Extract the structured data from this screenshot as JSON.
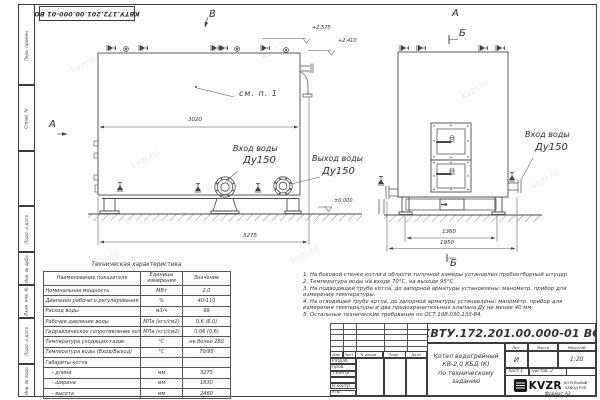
{
  "watermark": "kvzr.ru",
  "doc_number": "КВТУ.172.201.00.000-01 ВО",
  "margin_labels": [
    "Перв. примен.",
    "Справ. №",
    "Подп. и дата",
    "Инв. № дубл.",
    "Взам. инв. №",
    "Подп. и дата",
    "Инв. № подл."
  ],
  "views": {
    "front": {
      "label_top": "В",
      "label_left": "А",
      "callout": "см. п. 1",
      "dim_inner": "3020",
      "dim_overall": "3275",
      "elev_top": "+2.575",
      "elev_top2": "+2.410",
      "elev_zero": "±0.000",
      "inlet_line1": "Вход воды",
      "inlet_line2": "Ду150",
      "outlet_line1": "Выход воды",
      "outlet_line2": "Ду150"
    },
    "side": {
      "label_top": "А",
      "section_top": "Б",
      "section_bottom": "Б",
      "inlet_line1": "Вход воды",
      "inlet_line2": "Ду150",
      "dim_legs": "1360",
      "dim_overall": "1950"
    }
  },
  "spec_table": {
    "title": "Техническая характеристика",
    "headers": [
      "Наименование показателя",
      "Единицы измерения",
      "Значение"
    ],
    "rows": [
      [
        "Номинальная мощность",
        "МВт",
        "2,0"
      ],
      [
        "Диапазон рабочего регулирования",
        "%",
        "40-110"
      ],
      [
        "Расход воды",
        "м3/ч",
        "69"
      ],
      [
        "Рабочее давление воды",
        "МПа (кгс/см2)",
        "0,6 (6,0)"
      ],
      [
        "Гидравлическое сопротивление котла",
        "МПа (кгс/см2)",
        "0,06 (0,6)"
      ],
      [
        "Температура уходящих газов",
        "°С",
        "не более 280"
      ],
      [
        "Температура воды (Вход/Выход)",
        "°С",
        "70/95"
      ],
      [
        "Габариты котла",
        "",
        ""
      ],
      [
        "    - длина",
        "мм",
        "3275"
      ],
      [
        "    - ширина",
        "мм",
        "1830"
      ],
      [
        "    - высота",
        "мм",
        "2460"
      ]
    ]
  },
  "notes": [
    "1.  На боковой стенке котла в области топочной камеры установлен пробоотборный штуцер",
    "2.  Температура воды на входе 70°С, на выходе 95°С.",
    "3.  На подводящей трубе котла, до запорной арматуры установлены: манометр, прибор для измерения температуры.",
    "4.  На отводящей трубе котла, до запорной арматуры установлены: манометр, прибор для измерения температуры и два предохранительных клапана Ду не менее 40 мм.",
    "5.  Остальные технические требования по ОСТ 108.030.133-84."
  ],
  "title_block": {
    "doc_number": "КВТУ.172.201.00.000-01 ВО",
    "product_title": "Котел водогрейный\nКВ-2,0 КБД (К)\nпо техническому заданию",
    "rev_headers": [
      "Изм.",
      "Лист",
      "N докум.",
      "Подп.",
      "Дата"
    ],
    "sig_rows": [
      "Разраб.",
      "Пров.",
      "Т.контр.",
      "",
      "Н.контр.",
      "Утв."
    ],
    "lit_h": "Лит.",
    "mass_h": "Масса",
    "scale_h": "Масштаб",
    "lit_v": "И",
    "scale_v": "1:20",
    "sheet_h": "Лист",
    "sheet_v": "1",
    "sheets_h": "Листов",
    "sheets_v": "2",
    "logo_text": "KVZR",
    "company": "КОТЕЛЬНЫЙ\nЗАВОД РЭП",
    "format": "Формат  А3"
  }
}
